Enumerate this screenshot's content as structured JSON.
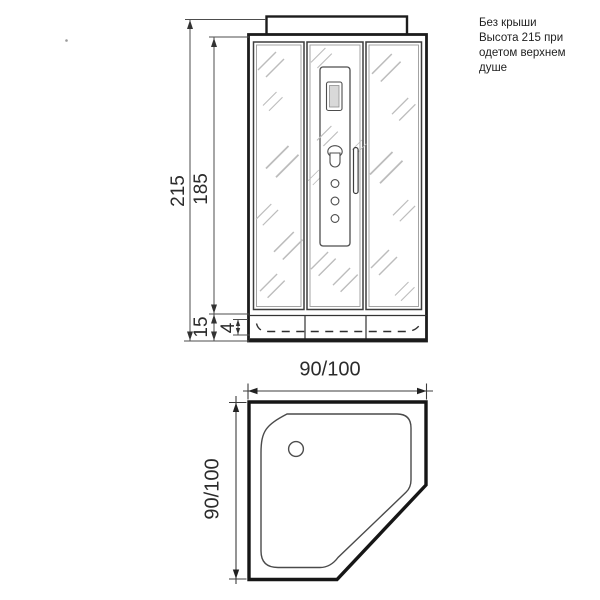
{
  "note": {
    "text": "Без крыши\nВысота 215 при\nодетом верхнем\nдуше"
  },
  "front_view": {
    "dims": {
      "total_height": "215",
      "glass_height": "185",
      "tray_height": "15",
      "tray_rim": "4"
    }
  },
  "plan_view": {
    "dims": {
      "width": "90/100",
      "depth": "90/100"
    }
  },
  "colors": {
    "line_main": "#1c1c1c",
    "line_thin": "#4d4d4d",
    "glass_hatch": "#bcbcbc",
    "display_fill": "#d9d9d9"
  }
}
